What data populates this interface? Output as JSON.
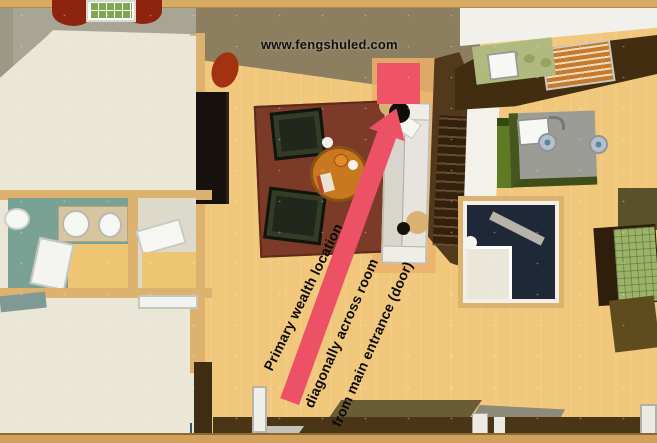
{
  "watermark": {
    "text": "www.fengshuled.com"
  },
  "annotations": {
    "primary": "Primary wealth location",
    "secondary_line1": "diagonally across room",
    "secondary_line2": "from main entrance (door)"
  },
  "colors": {
    "arrow_pink": "#ec5166",
    "wealth_square_pink": "#ee5367",
    "wood_floor": "#f0c77b",
    "carpet_cream": "#eae7d6",
    "rug_maroon": "#7c3a28",
    "upper_wall_khaki": "#8c7e5e",
    "right_wall_brown": "#53391b",
    "bedroom_wall_gray_green": "#a8a595",
    "bathroom_teal": "#7aa294",
    "stairwell_navy": "#1e2836",
    "kitchen_counter_green": "#b0ba7e",
    "island_gray": "#9c9c96",
    "dining_table_green": "#9cb46a",
    "coffee_table_orange": "#c8791f"
  }
}
